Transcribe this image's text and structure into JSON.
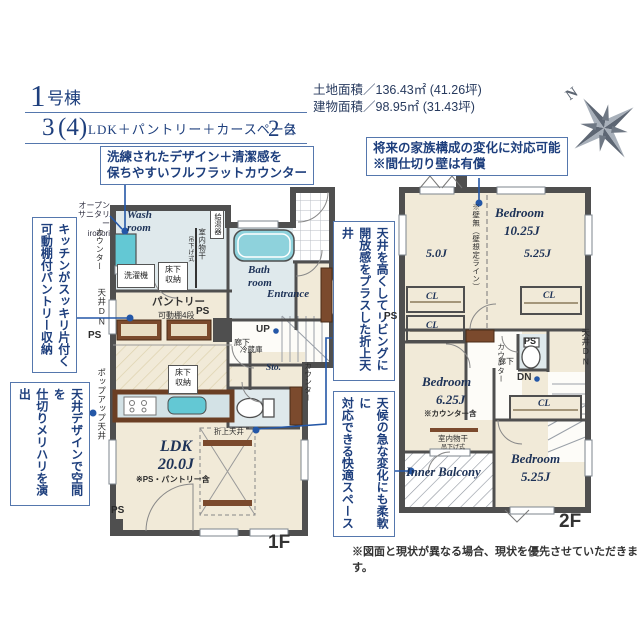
{
  "palette": {
    "navy": "#1e3f7d",
    "connector": "#2457a7",
    "wall": "#4f4f4f",
    "floor_cream": "#f1ead8",
    "wet_blue": "#dfe9ec",
    "fixture_teal": "#63c8d4",
    "wood_brown": "#7b4a2d"
  },
  "header": {
    "unit_big": "1",
    "unit_small": "号棟",
    "plan_num": "3",
    "plan_paren": "(4)",
    "plan_mid": "LDK＋パントリー＋カースペース",
    "plan_two": "2",
    "plan_dai": "台",
    "land_area": "土地面積／136.43㎡ (41.26坪)",
    "building_area": "建物面積／98.95㎡ (31.43坪)",
    "compass_n": "N"
  },
  "callouts": {
    "counter": "洗練されたデザイン＋清潔感を\n保ちやすいフルフラットカウンター",
    "pantry": "キッチンがスッキリ片付く\n可動棚付パントリー収納",
    "ceiling_design": "天井デザインで空間を\n仕切りメリハリを演出",
    "future": "将来の家族構成の変化に対応可能\n※間仕切り壁は有償",
    "oriage": "天井を高くしてリビングに\n開放感をプラスした折上天井",
    "balcony": "天候の急な変化にも柔軟に\n対応できる快適スペース"
  },
  "floor1": {
    "tag": "1F",
    "labels": {
      "open_sanitary": "オープン\nサニタリー\nirodori",
      "counter_left": "カウンター",
      "ceiling_dn": "天井DN",
      "ps": "PS",
      "popup_ceiling": "ポップアップ天井",
      "wash_room": "Wash\nroom",
      "water_heater": "給湯器",
      "laundry_pole": "室内物干",
      "laundry_pole_sub": "吊下げ式",
      "washer": "洗濯機",
      "underfloor": "床下\n収納",
      "bath_room": "Bath\nroom",
      "entrance": "Entrance",
      "pantry": "パントリー",
      "shelf": "可動棚4段",
      "fridge": "冷蔵庫",
      "sto": "Sto.",
      "up": "UP",
      "hallway": "廊下",
      "counter_right": "カウンター",
      "ldk": "LDK\n20.0J",
      "ldk_note": "※PS・パントリー含",
      "oriage": "折上天井"
    }
  },
  "floor2": {
    "tag": "2F",
    "labels": {
      "bedroom": "Bedroom",
      "size_main": "10.25J",
      "size_left": "5.0J",
      "size_right": "5.25J",
      "wall_note": "※壁無（壁想定ライン）",
      "cl": "CL",
      "ps": "PS",
      "counter": "カウンター",
      "ceiling_dn": "天井DN",
      "hallway": "廊下",
      "dn": "DN",
      "size_2": "6.25J",
      "bedroom2_note": "※カウンター含",
      "laundry_pole": "室内物干",
      "laundry_pole_sub": "吊下げ式",
      "size_3": "5.25J",
      "inner_balcony": "Inner Balcony"
    }
  },
  "footnote": "※図面と現状が異なる場合、現状を優先させていただきます。"
}
